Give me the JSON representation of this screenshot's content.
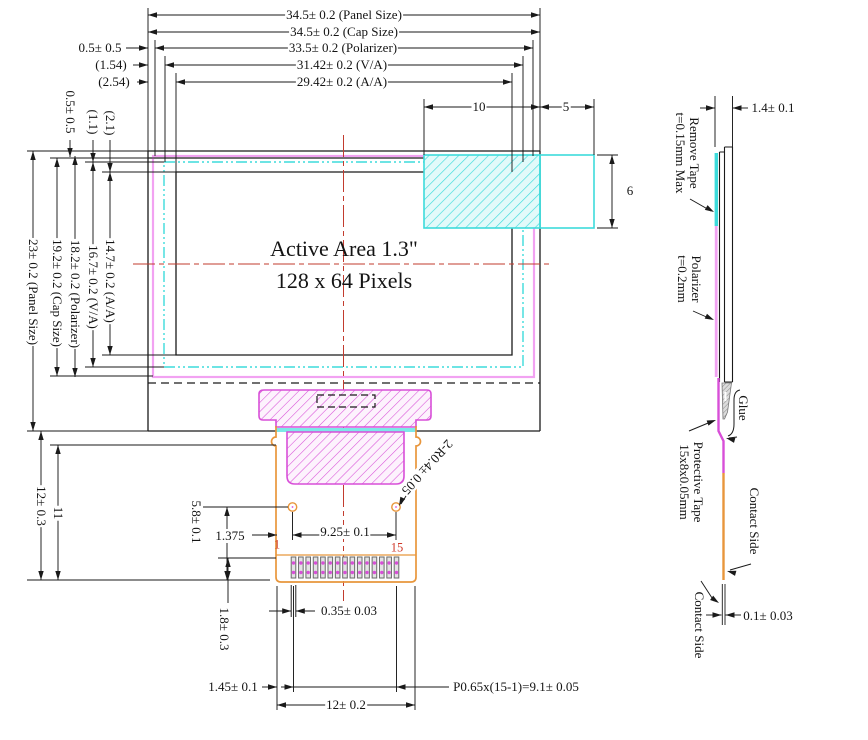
{
  "drawing": {
    "active_area": {
      "line1": "Active Area 1.3\"",
      "line2": "128 x 64 Pixels"
    },
    "top_dims": {
      "panel": "34.5± 0.2 (Panel Size)",
      "cap": "34.5± 0.2 (Cap Size)",
      "polarizer": "33.5± 0.2 (Polarizer)",
      "va": "31.42± 0.2 (V/A)",
      "aa": "29.42± 0.2 (A/A)",
      "left_offset_polarizer": "0.5± 0.5",
      "left_offset_va": "(1.54)",
      "left_offset_aa": "(2.54)",
      "tape_width": "10",
      "tape_tab": "5",
      "tape_height": "6"
    },
    "top_offsets_rotated": {
      "cap": "0.5± 0.5",
      "va": "(1.1)",
      "aa": "(2.1)"
    },
    "left_dims": {
      "panel": "23± 0.2 (Panel Size)",
      "cap": "19.2± 0.2 (Cap Size)",
      "polarizer": "18.2± 0.2 (Polarizer)",
      "va": "16.7± 0.2 (V/A)",
      "aa": "14.7± 0.2 (A/A)",
      "fpc_total": "12± 0.3",
      "fpc_exposed": "11"
    },
    "fpc_dims": {
      "hole_offset_y": "5.8± 0.1",
      "hole_offset_x": "1.375",
      "hole_pitch": "9.25± 0.1",
      "hole_radius": "2-R0.4± 0.05",
      "pin_first": "1",
      "pin_last": "15",
      "pin_length": "1.8± 0.3",
      "pin_width": "0.35± 0.03",
      "pin_margin": "1.45± 0.1",
      "pin_pitch": "P0.65x(15-1)=9.1± 0.05",
      "fpc_width": "12± 0.2"
    },
    "side_view": {
      "thickness": "1.4± 0.1",
      "remove_tape_line1": "Remove Tape",
      "remove_tape_line2": "t=0.15mm Max",
      "polarizer_line1": "Polarizer",
      "polarizer_line2": "t=0.2mm",
      "glue": "Glue",
      "protective_tape_line1": "Protective Tape",
      "protective_tape_line2": "15x8x0.05mm",
      "contact_side_right": "Contact Side",
      "contact_side_left": "Contact Side",
      "contact_thickness": "0.1± 0.03"
    },
    "colors": {
      "outline": "#1a1a1a",
      "red_centerline": "#c23b2e",
      "cyan": "#3ddbdb",
      "cyan_fill": "#e2fafa",
      "cyan_strip": "#7de8e8",
      "magenta": "#d84fd8",
      "magenta_fill": "#fdf2fd",
      "pink": "#f2a2f2",
      "orange": "#e8963c",
      "pin_number_red": "#cf3a2a",
      "glue_gray": "#8a8a8a"
    }
  }
}
